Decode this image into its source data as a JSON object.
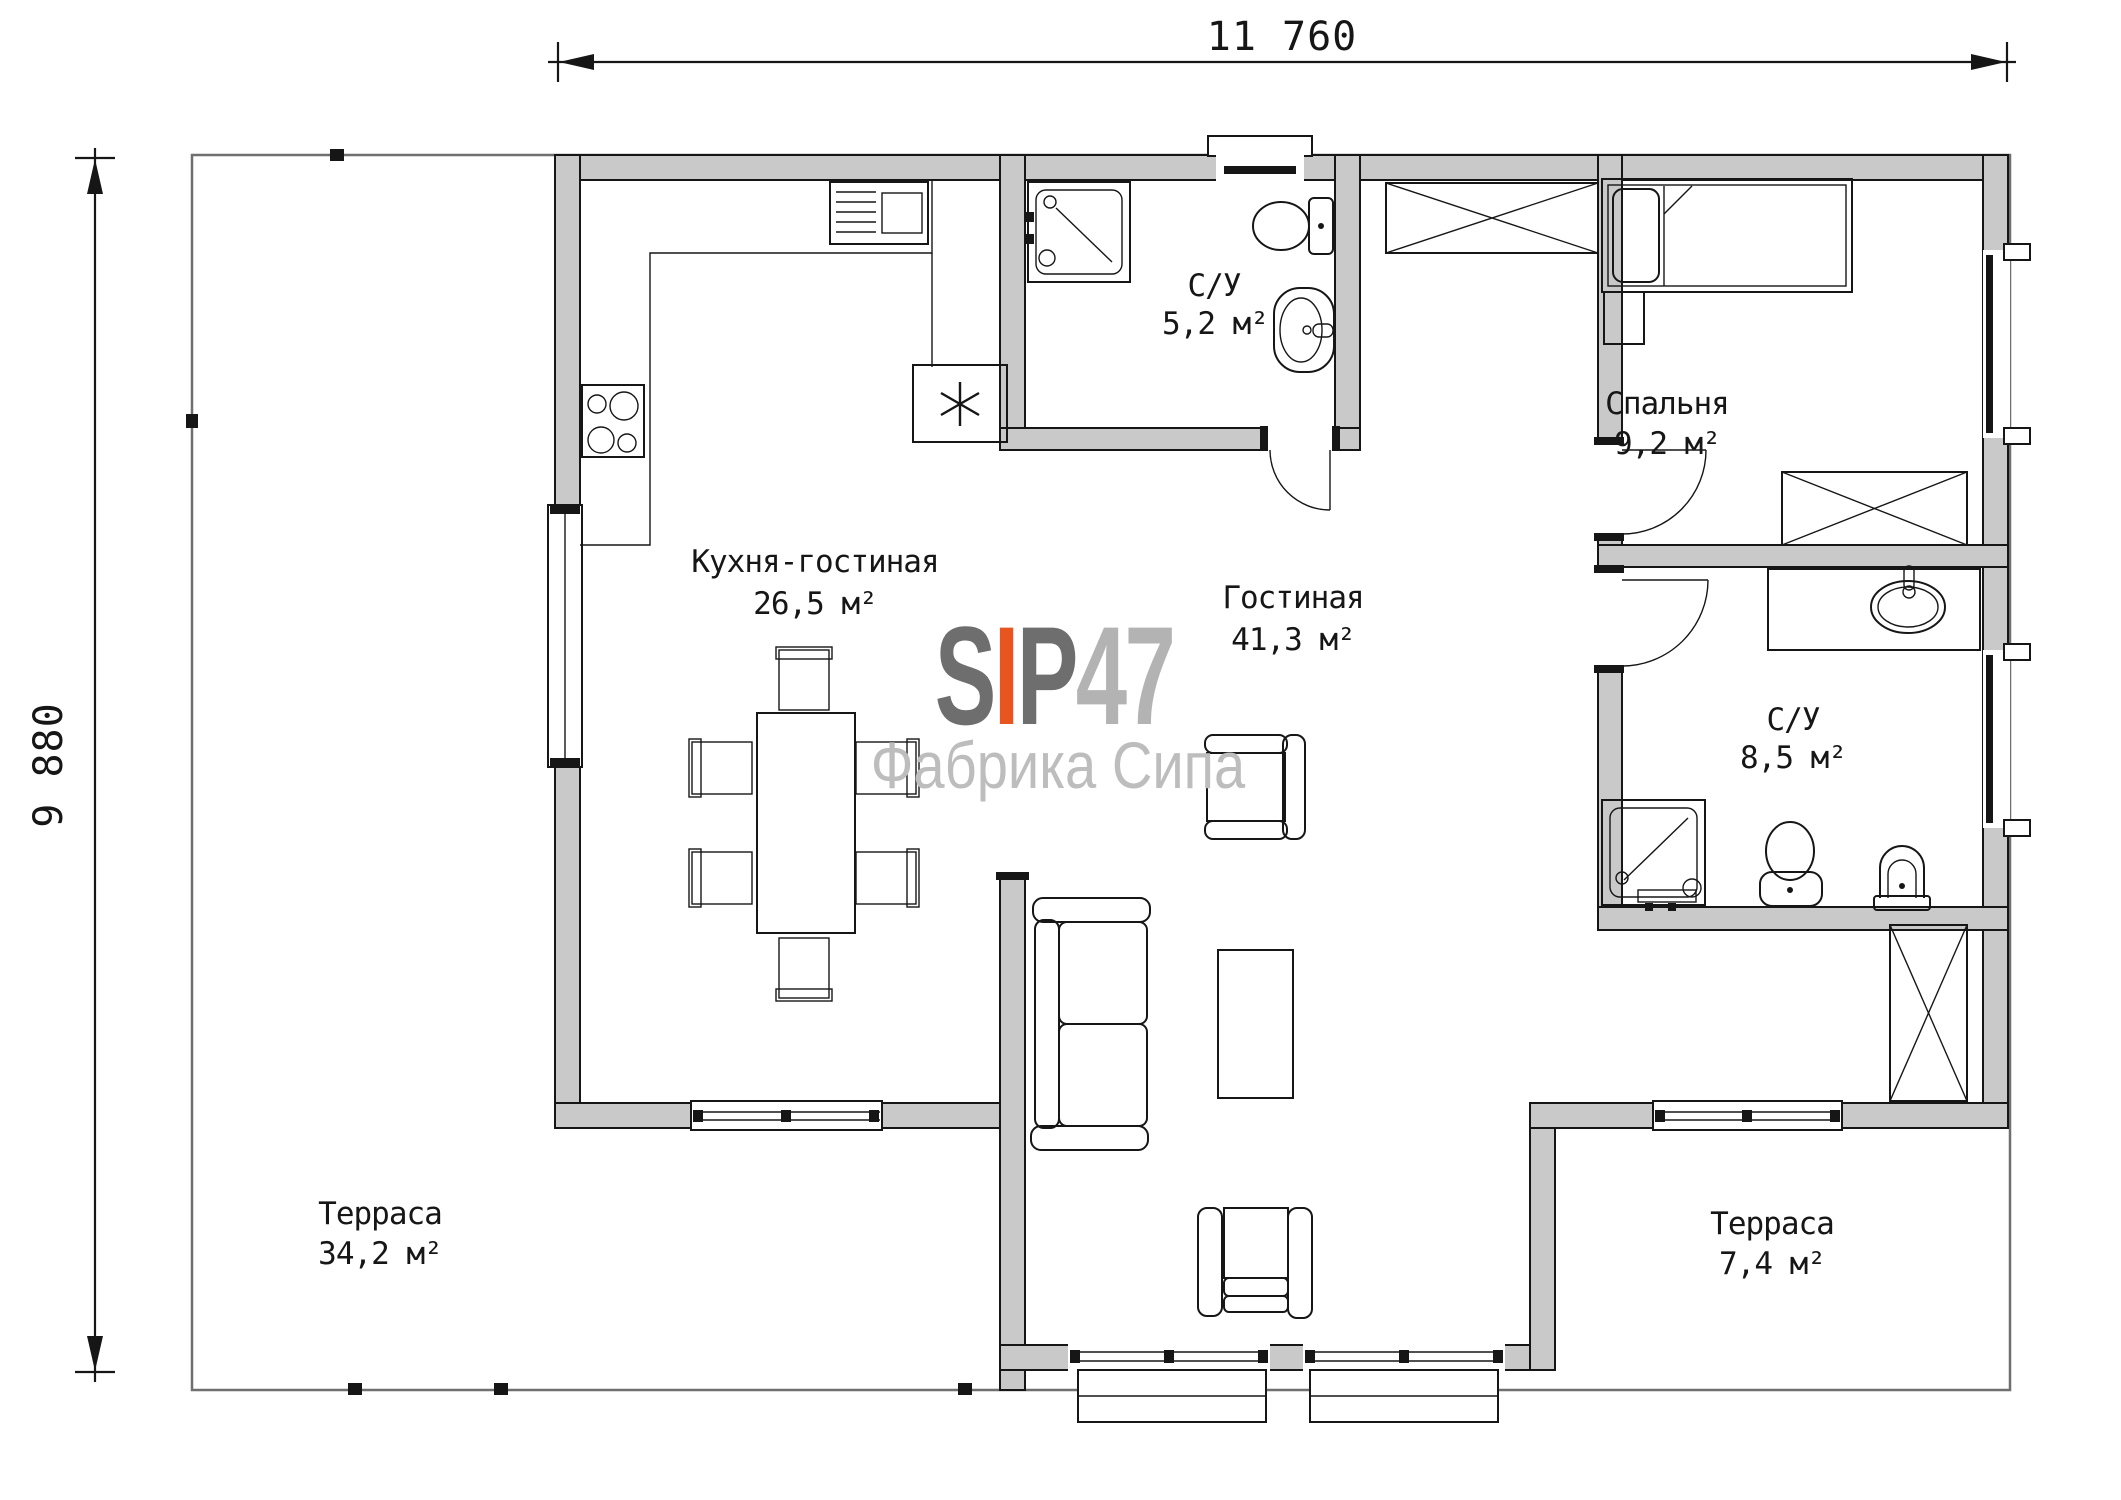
{
  "plan": {
    "dim_top": "11 760",
    "dim_left": "9 880",
    "rooms": {
      "kitchen_living": {
        "name": "Кухня-гостиная",
        "area": "26,5 м²"
      },
      "living": {
        "name": "Гостиная",
        "area": "41,3 м²"
      },
      "bath1": {
        "name": "С/У",
        "area": "5,2 м²"
      },
      "bedroom": {
        "name": "Спальня",
        "area": "9,2 м²"
      },
      "bath2": {
        "name": "С/У",
        "area": "8,5 м²"
      },
      "terrace_left": {
        "name": "Терраса",
        "area": "34,2 м²"
      },
      "terrace_right": {
        "name": "Терраса",
        "area": "7,4 м²"
      }
    },
    "logo": {
      "s": "S",
      "i": "I",
      "p": "P",
      "num": "47",
      "subtitle": "Фабрика Сипа"
    },
    "colors": {
      "wall_fill": "#c9c9c9",
      "line": "#161616",
      "deck_line": "#6f6f6f",
      "logo_dark": "#6e6e6e",
      "logo_orange": "#e8551f",
      "logo_light": "#b3b3b3",
      "logo_subtitle": "#bdbdbd"
    }
  }
}
